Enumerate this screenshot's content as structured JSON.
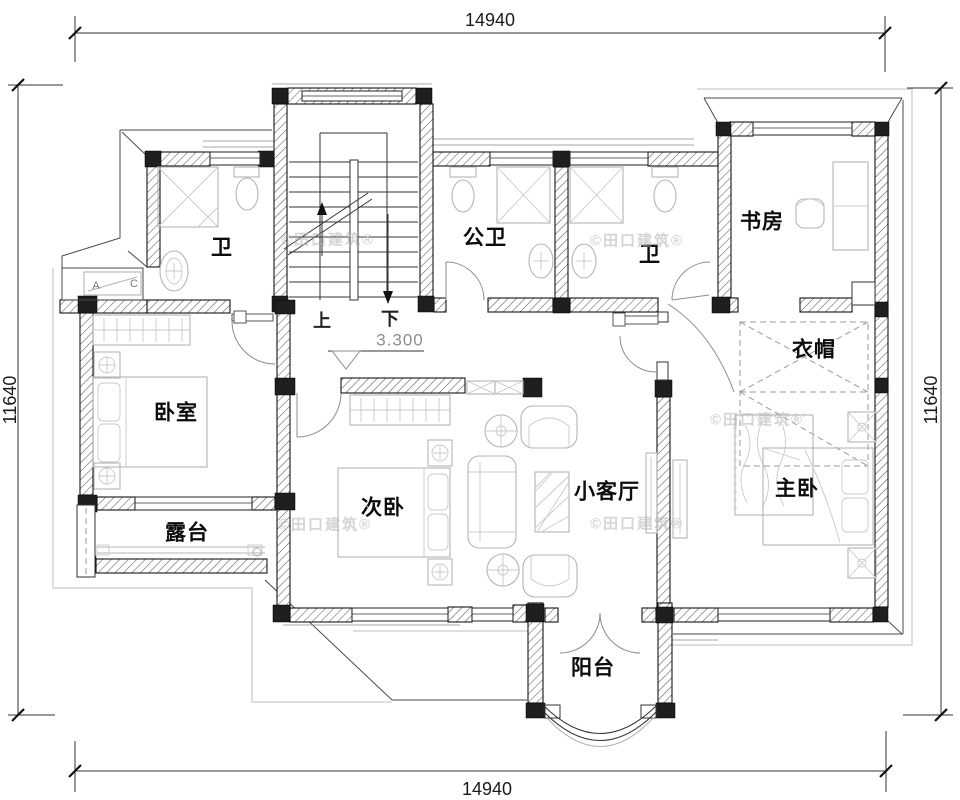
{
  "dimensions": {
    "top": "14940",
    "bottom": "14940",
    "left": "11640",
    "right": "11640"
  },
  "rooms": {
    "bath1": "卫",
    "public_bath": "公卫",
    "bath2": "卫",
    "study": "书房",
    "cloakroom": "衣帽",
    "bedroom": "卧室",
    "second_bedroom": "次卧",
    "small_living_room": "小客厅",
    "master_bedroom": "主卧",
    "terrace": "露台",
    "balcony": "阳台"
  },
  "stairs": {
    "up": "上",
    "down": "下",
    "elevation": "3.300"
  },
  "ac_unit": {
    "a": "A",
    "c": "C"
  },
  "watermark": "©田口建筑®",
  "colors": {
    "wall": "#1f1f1f",
    "fixture": "#b5b5b5",
    "roof_gray": "#c9c9c9",
    "dim": "#333333"
  }
}
